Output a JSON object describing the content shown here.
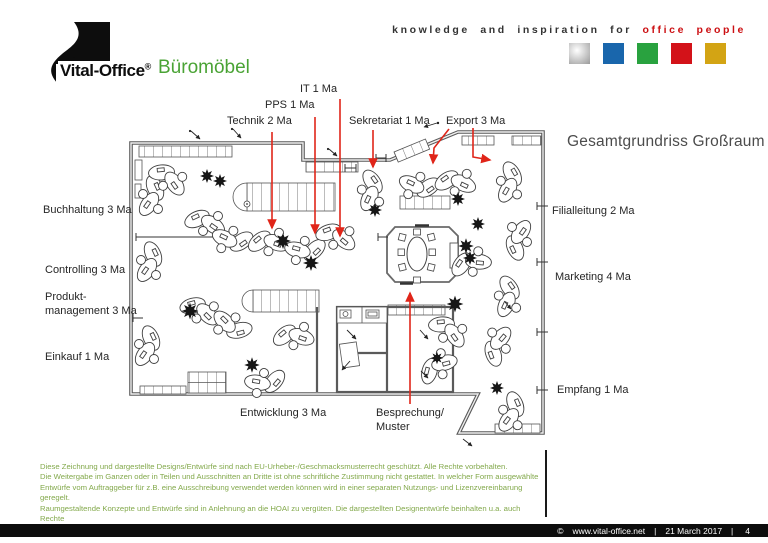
{
  "header": {
    "brand_name": "Vital-Office",
    "brand_registered": "®",
    "brand_product": "Büromöbel",
    "tagline_black": "knowledge and inspiration for",
    "tagline_red": "office people",
    "palette": {
      "silver": "#b9b9b9",
      "blue": "#1966ac",
      "green": "#29a23f",
      "red": "#d31219",
      "yellow": "#d3a414"
    }
  },
  "plan": {
    "title": "Gesamtgrundriss Großraum",
    "labels": {
      "it": "IT 1 Ma",
      "pps": "PPS 1 Ma",
      "technik": "Technik 2 Ma",
      "sekretariat": "Sekretariat 1 Ma",
      "export": "Export 3 Ma",
      "buchhaltung": "Buchhaltung 3 Ma",
      "controlling": "Controlling 3 Ma",
      "produktmanagement": "Produkt-\nmanagement 3 Ma",
      "einkauf": "Einkauf 1 Ma",
      "entwicklung": "Entwicklung 3 Ma",
      "besprechung": "Besprechung/\nMuster",
      "filialleitung": "Filialleitung 2 Ma",
      "marketing": "Marketing 4 Ma",
      "empfang": "Empfang 1 Ma"
    },
    "arrow_color": "#e02519"
  },
  "legal": {
    "lines": [
      "Diese Zeichnung und dargestellte Designs/Entwürfe sind nach EU-Urheber-/Geschmacksmusterrecht geschützt. Alle Rechte vorbehalten.",
      "Die Weitergabe im Ganzen oder in Teilen und Ausschnitten an Dritte ist ohne schriftliche Zustimmung nicht gestattet. In welcher Form ausgewählte",
      "Entwürfe vom Auftraggeber für z.B. eine Ausschreibung verwendet werden können wird in einer separaten Nutzungs- und Lizenzvereinbarung geregelt.",
      "Raumgestaltende Konzepte und Entwürfe sind in Anlehnung an die HOAI zu vergüten. Die dargestellten Designentwürfe beinhalten u.a. auch Rechte",
      "Dritter. Das Veröffentlichungsrecht verbleibt beim Urheber (Vital-Office). Der Auftraggeber haftet im Falle missbräuchlicher Verwendung."
    ]
  },
  "footer": {
    "copyright": "©",
    "website": "www.vital-office.net",
    "separator": "|",
    "date": "21 March 2017",
    "page": "4"
  }
}
